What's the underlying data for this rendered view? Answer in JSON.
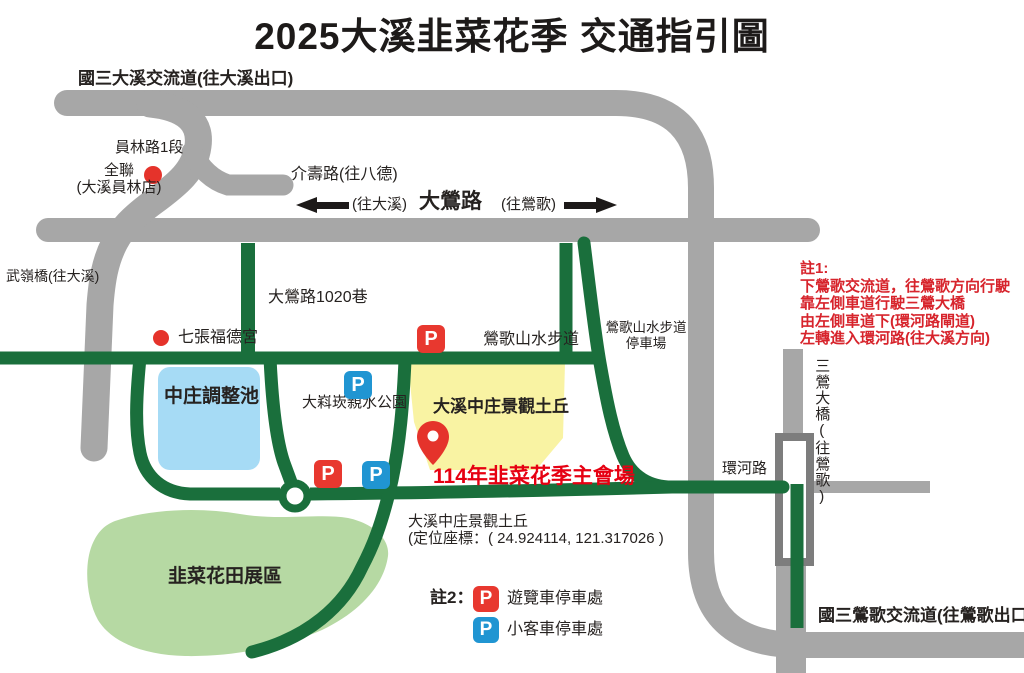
{
  "title": "2025大溪韭菜花季 交通指引圖",
  "labels": {
    "daxi_interchange": "國三大溪交流道(往大溪出口)",
    "yuanlin_rd": "員林路1段",
    "pxmart_line1": "全聯",
    "pxmart_line2": "(大溪員林店)",
    "jieshou_rd": "介壽路(往八德)",
    "to_daxi": "(往大溪)",
    "daying_rd": "大鶯路",
    "to_yingge": "(往鶯歌)",
    "wuling_bridge": "武嶺橋(往大溪)",
    "daying_lane": "大鶯路1020巷",
    "qizhang_temple": "七張福德宮",
    "yingge_trail": "鶯歌山水步道",
    "trail_parking_line1": "鶯歌山水步道",
    "trail_parking_line2": "停車場",
    "pond": "中庄調整池",
    "waterfront_park": "大嵙崁親水公園",
    "landscape_hill": "大溪中庄景觀土丘",
    "main_venue": "114年韭菜花季主會場",
    "venue_name": "大溪中庄景觀土丘",
    "venue_coords": "(定位座標：( 24.924114, 121.317026 )",
    "flower_field": "韭菜花田展區",
    "huanhe_rd": "環河路",
    "sanying_bridge": "三鶯大橋(往鶯歌)",
    "yingge_interchange": "國三鶯歌交流道(往鶯歌出口)"
  },
  "note1": {
    "heading": "註1:",
    "lines": [
      "下鶯歌交流道，往鶯歌方向行駛",
      "靠左側車道行駛三鶯大橋",
      "由左側車道下(環河路閘道)",
      "左轉進入環河路(往大溪方向)"
    ]
  },
  "legend": {
    "heading": "註2：",
    "p_letter": "P",
    "bus_parking": "遊覽車停車處",
    "car_parking": "小客車停車處"
  },
  "colors": {
    "road_gray": "#a7a7a7",
    "bridge_outline": "#7d7d7d",
    "road_green": "#1a6f3c",
    "field_green": "#b6d9a3",
    "pond_blue": "#a6dbf5",
    "hill_yellow": "#f9f3a3",
    "marker_red": "#e5332b",
    "note_red": "#d7242c",
    "venue_red": "#e60012",
    "p_blue": "#2095d2",
    "p_red": "#e8382f"
  }
}
